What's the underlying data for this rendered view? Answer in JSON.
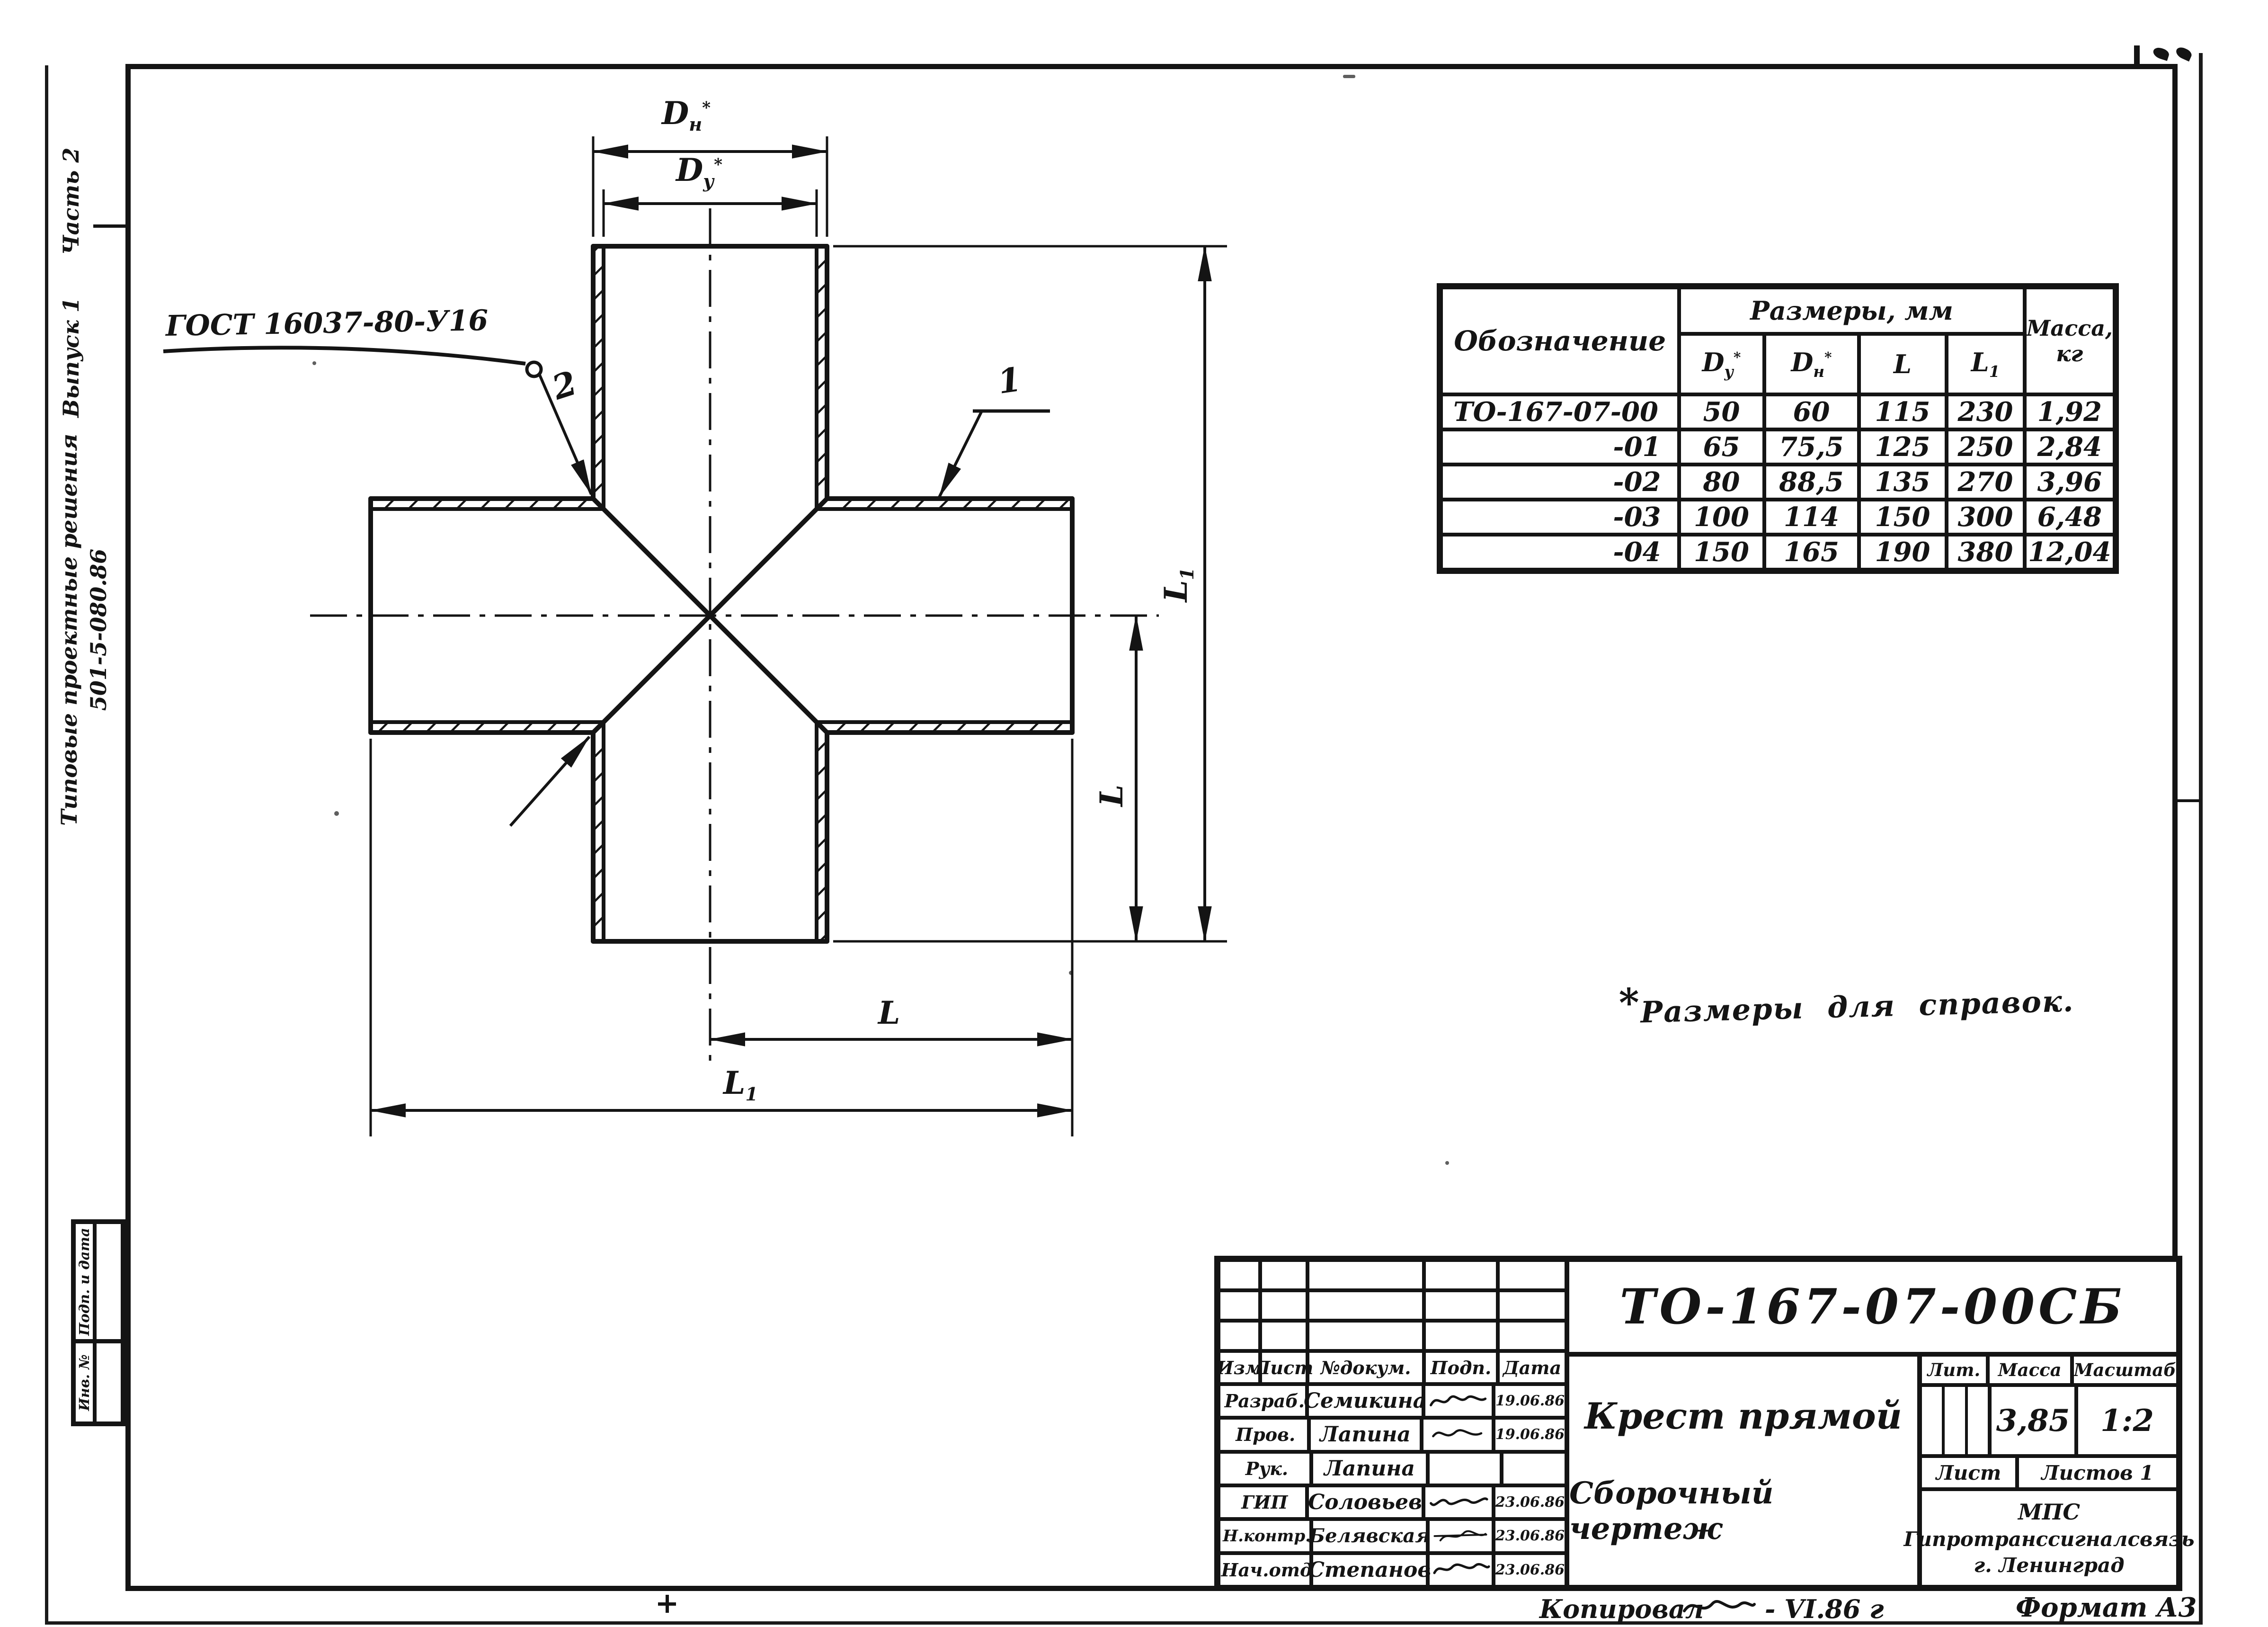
{
  "sidebar": {
    "part": "Часть 2",
    "issue": "Выпуск 1",
    "series": "Типовые проектные решения",
    "code": "501-5-080.86"
  },
  "margin_stamps": {
    "podp_data": "Подп. и дата",
    "inv_no": "Инв. №"
  },
  "drawing": {
    "gost_callout": "ГОСТ 16037-80-У16",
    "pos_1": "1",
    "pos_2": "2",
    "dim_parts": {
      "D": "D",
      "sub_n": "н",
      "sub_u": "у",
      "star": "*",
      "L": "L",
      "sub_1": "1"
    },
    "note_star": "*",
    "note": "Размеры для справок."
  },
  "table": {
    "col_designation": "Обозначение",
    "col_sizes": "Размеры, мм",
    "col_mass_line1": "Масса,",
    "col_mass_line2": "кг",
    "rows": [
      {
        "designation": "ТО-167-07-00",
        "du": "50",
        "dn": "60",
        "l": "115",
        "l1": "230",
        "mass": "1,92"
      },
      {
        "designation": "-01",
        "du": "65",
        "dn": "75,5",
        "l": "125",
        "l1": "250",
        "mass": "2,84"
      },
      {
        "designation": "-02",
        "du": "80",
        "dn": "88,5",
        "l": "135",
        "l1": "270",
        "mass": "3,96"
      },
      {
        "designation": "-03",
        "du": "100",
        "dn": "114",
        "l": "150",
        "l1": "300",
        "mass": "6,48"
      },
      {
        "designation": "-04",
        "du": "150",
        "dn": "165",
        "l": "190",
        "l1": "380",
        "mass": "12,04"
      }
    ]
  },
  "titleblock": {
    "doc_no": "ТО-167-07-00СБ",
    "title_line1": "Крест прямой",
    "title_line2": "Сборочный чертеж",
    "lit_label": "Лит.",
    "mass_label": "Масса",
    "scale_label": "Масштаб",
    "mass_value": "3,85",
    "scale_value": "1:2",
    "sheet_label": "Лист",
    "sheets_label": "Листов 1",
    "org_line1": "МПС",
    "org_line2": "Гипротранссигналсвязь",
    "org_line3": "г. Ленинград",
    "chg_headers": [
      "Изм",
      "Лист",
      "№докум.",
      "Подп.",
      "Дата"
    ],
    "sig_rows": [
      {
        "role": "Разраб.",
        "name": "Семикина",
        "date": "19.06.86"
      },
      {
        "role": "Пров.",
        "name": "Лапина",
        "date": "19.06.86"
      },
      {
        "role": "Рук.",
        "name": "Лапина",
        "date": ""
      },
      {
        "role": "ГИП",
        "name": "Соловьев",
        "date": "23.06.86"
      },
      {
        "role": "Н.контр.",
        "name": "Белявская",
        "date": "23.06.86"
      },
      {
        "role": "Нач.отд",
        "name": "Степанов",
        "date": "23.06.86"
      }
    ]
  },
  "footer": {
    "copied_label": "Копировал",
    "copied_date": "- VI.86 г",
    "format": "Формат А3"
  }
}
